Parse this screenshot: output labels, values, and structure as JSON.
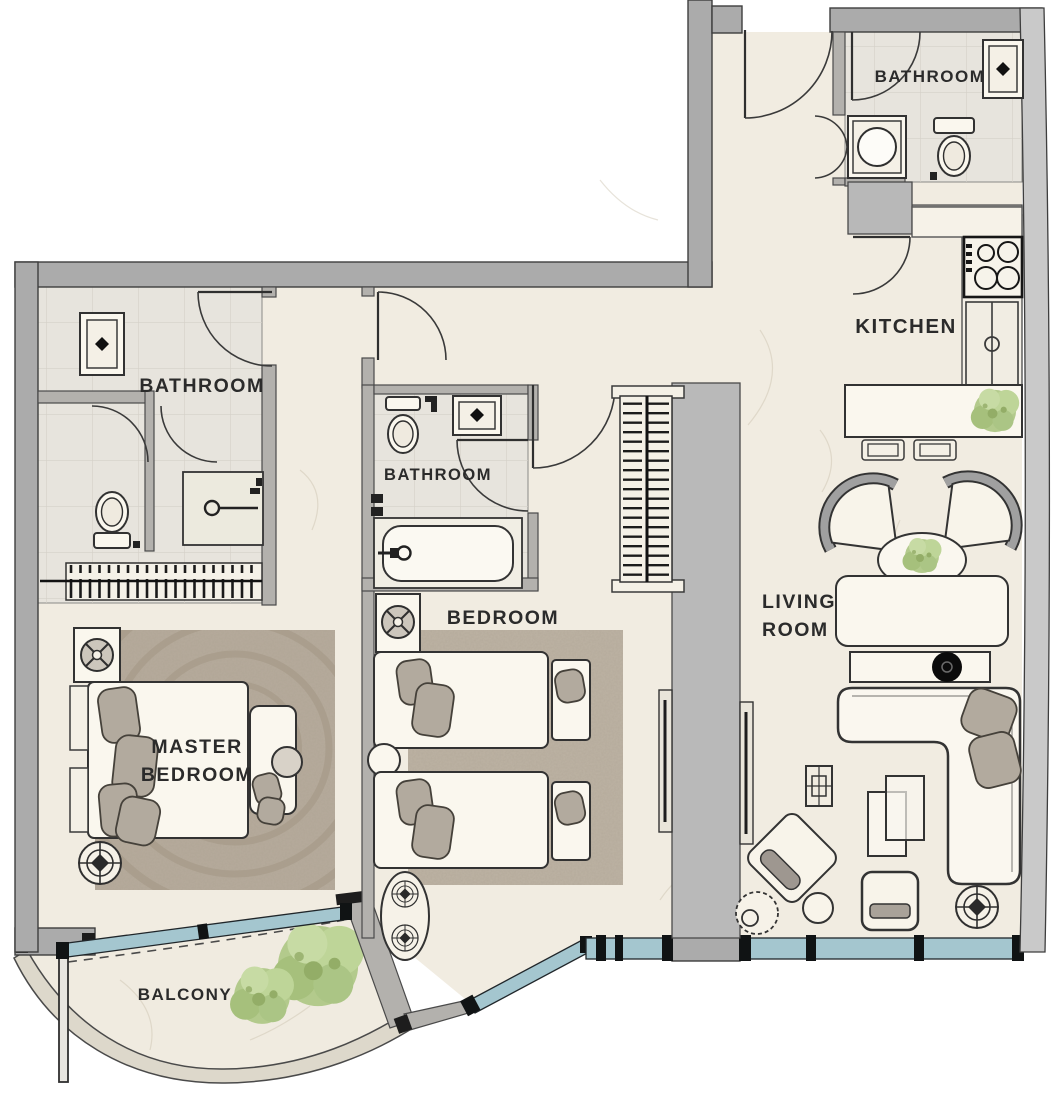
{
  "plan": {
    "title": "apartment-floor-plan",
    "labels": {
      "bathroom_top": "BATHROOM",
      "kitchen": "KITCHEN",
      "bathroom_left": "BATHROOM",
      "bathroom_middle": "BATHROOM",
      "master_line1": "MASTER",
      "master_line2": "BEDROOM",
      "bedroom": "BEDROOM",
      "living_line1": "LIVING",
      "living_line2": "ROOM",
      "balcony": "BALCONY"
    },
    "rooms": [
      {
        "id": "bathroom-top-right",
        "label": "BATHROOM",
        "fixtures": [
          "sink",
          "toilet",
          "washing-machine",
          "swing-door",
          "bifold-door"
        ]
      },
      {
        "id": "kitchen",
        "label": "KITCHEN",
        "fixtures": [
          "stove-4-burner",
          "counter",
          "counter-sink",
          "island-counter",
          "bar-stool",
          "bar-stool",
          "plant",
          "entry-closet",
          "door"
        ]
      },
      {
        "id": "bathroom-left",
        "label": "BATHROOM",
        "fixtures": [
          "sink",
          "toilet",
          "shower",
          "hanger-wardrobe",
          "door",
          "door"
        ]
      },
      {
        "id": "bathroom-middle",
        "label": "BATHROOM",
        "fixtures": [
          "sink",
          "toilet",
          "bathtub",
          "door"
        ]
      },
      {
        "id": "master-bedroom",
        "label": "MASTER BEDROOM",
        "fixtures": [
          "double-bed",
          "pillows",
          "rug",
          "nightstand-lamp",
          "ceiling-fan-symbol",
          "vanity-desk",
          "stool"
        ]
      },
      {
        "id": "bedroom",
        "label": "BEDROOM",
        "fixtures": [
          "twin-bed",
          "twin-bed",
          "bench",
          "bench",
          "rug",
          "nightstand-lamp",
          "round-stool",
          "hanger-closet",
          "oval-decor",
          "ceiling-fan-symbol",
          "ceiling-fan-symbol"
        ]
      },
      {
        "id": "living-room",
        "label": "LIVING ROOM",
        "fixtures": [
          "fan-armchair",
          "fan-armchair",
          "oval-coffee-table",
          "plant",
          "dining-table",
          "tv-console",
          "l-shaped-sofa",
          "sofa-pillows",
          "nesting-tables",
          "rotated-armchair",
          "round-side-table",
          "stool",
          "ottoman",
          "ceiling-fan-symbol",
          "floor-outlet"
        ]
      },
      {
        "id": "balcony",
        "label": "BALCONY",
        "fixtures": [
          "tree",
          "tree",
          "balcony-door",
          "dashed-threshold",
          "curved-parapet"
        ]
      },
      {
        "id": "entry-hall",
        "label": "",
        "fixtures": [
          "entry-door"
        ]
      }
    ],
    "colors": {
      "wall": "#ababab",
      "wall_outline": "#3e3e3e",
      "floor": "#f1ece1",
      "tile": "#e7e4dd",
      "glazing": "#a4c6cf",
      "mullion": "#101314",
      "plant_green": "#b6cd8f",
      "rug": "#b5ab9d",
      "furniture": "#faf7ee",
      "outline": "#2f2f2f",
      "label_text": "#2b2b2b"
    }
  }
}
